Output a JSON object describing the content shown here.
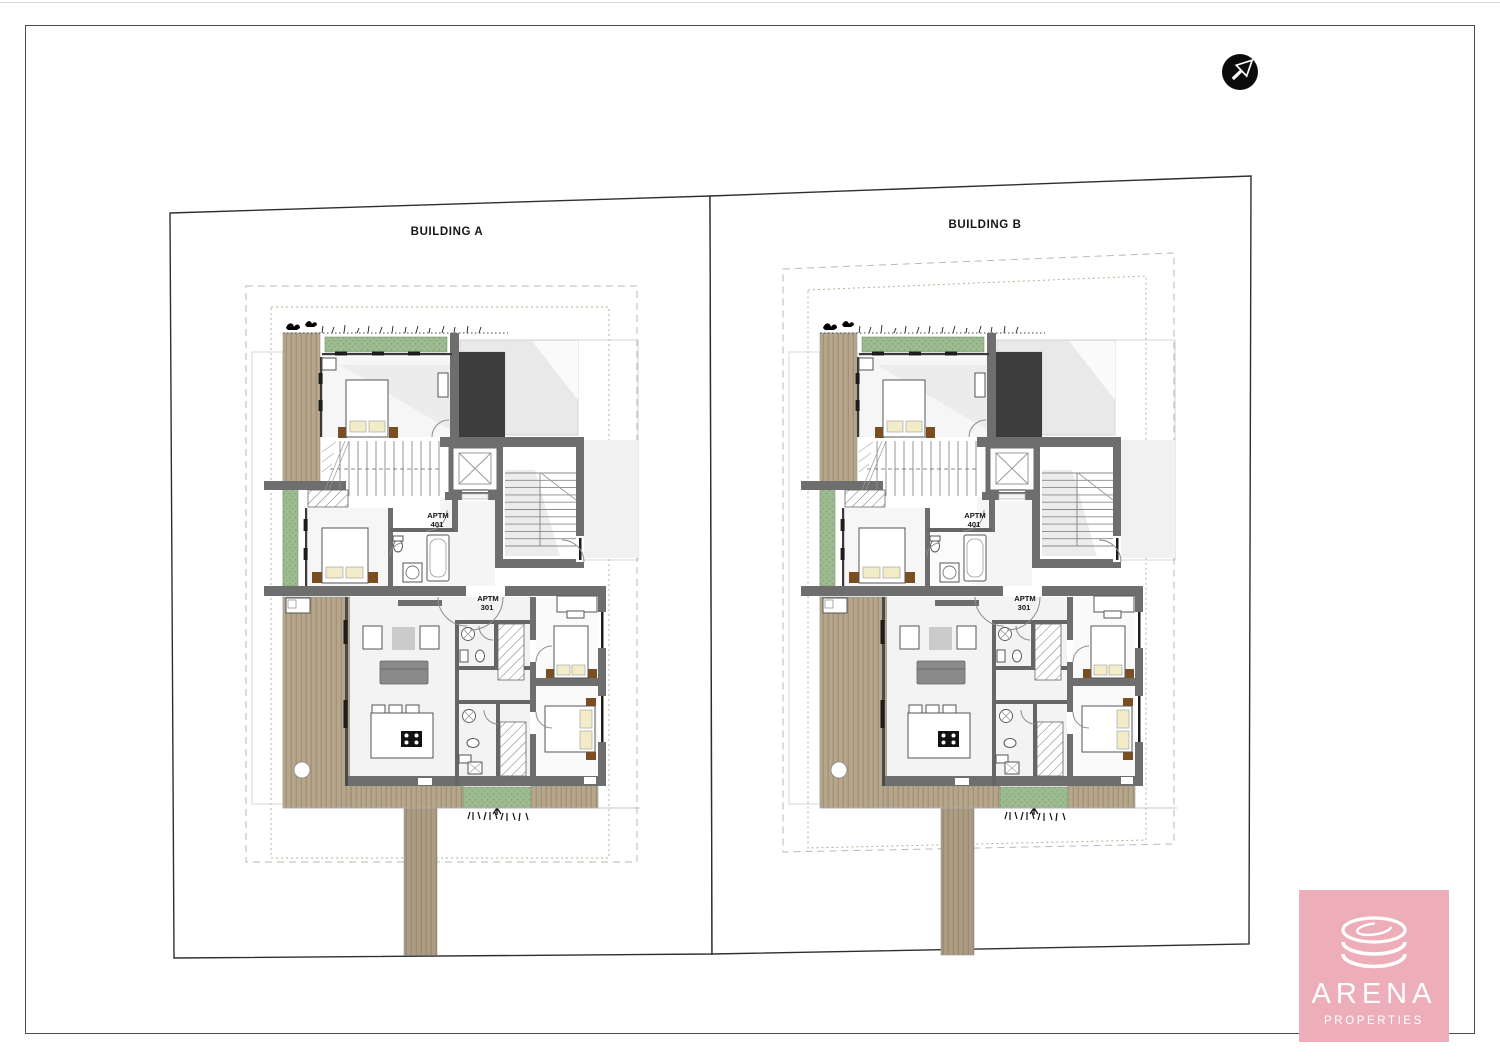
{
  "sheet": {
    "building_a_label": "BUILDING A",
    "building_b_label": "BUILDING B"
  },
  "plan": {
    "apartment_upper": {
      "line1": "APTM",
      "line2": "401"
    },
    "apartment_lower": {
      "line1": "APTM",
      "line2": "301"
    }
  },
  "logo": {
    "brand": "ARENA",
    "subtitle": "PROPERTIES"
  },
  "colors": {
    "wall_gray": "#6e6e6e",
    "charcoal_roof": "#3d3d3d",
    "deck_wood": "#b6a68b",
    "deck_wood_stripe": "#9b8a6f",
    "path_wood": "#ab9c83",
    "path_wood_stripe": "#93846c",
    "planter_green": "#9dbb90",
    "planter_green_dot": "#83a276",
    "shadow_gray": "#e9e9e9",
    "room_gray": "#f3f3f3",
    "pillow_cream": "#f3ecc9",
    "nightstand_brown": "#7a4e20",
    "sofa_gray": "#8a8a8a",
    "coffee_table_gray": "#cbcbcb",
    "logo_pink": "#edaeb9",
    "parcel_line": "#2e2e2e",
    "boundary_dash_gray": "#b9b9b9",
    "boundary_dash_green": "#9fbc92"
  }
}
